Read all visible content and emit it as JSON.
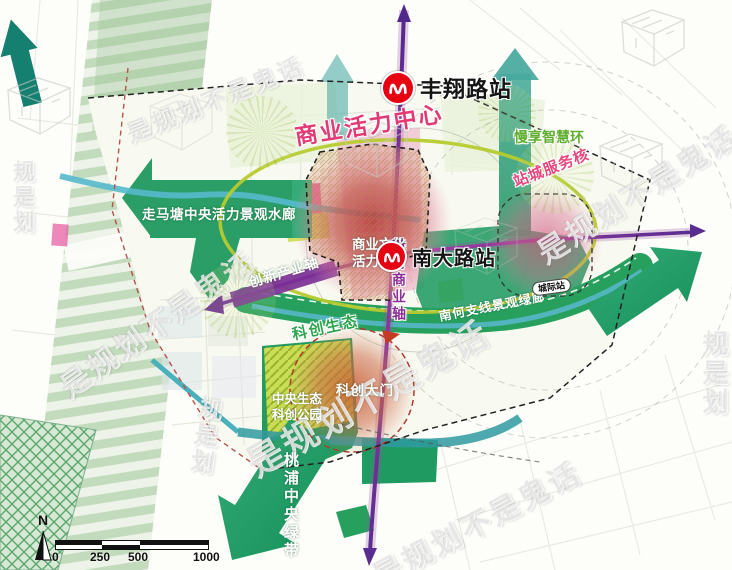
{
  "map": {
    "stations": {
      "fengxiang": "丰翔路站",
      "nanda": "南大路站",
      "intercity": "城际站"
    },
    "labels": {
      "commercial_center": "商业活力中心",
      "smart_ring": "慢享智慧环",
      "station_city_core": "站城服务核",
      "water_corridor": "走马塘中央活力景观水廊",
      "innovation_axis": "创新产业轴",
      "charm_commerce_axis": "魅力商业轴",
      "scitech_eco_axis": "科创生态",
      "nanhe_green_corridor": "南何支线景观绿廊",
      "commerce_park_line1": "商业文化",
      "commerce_park_line2": "活力公园",
      "scitech_gate": "科创大门",
      "central_park_line1": "中央生态",
      "central_park_line2": "科创公园",
      "taopu_green_belt": "桃浦中央绿带"
    },
    "legend": {
      "north": "N",
      "scale": {
        "t0": "0",
        "t1": "250",
        "t2": "500",
        "t3": "1000"
      }
    },
    "watermark": {
      "phrase": "是规划不是鬼话",
      "stamp": "规是划"
    },
    "colors": {
      "metro_red": "#e60012",
      "axis_purple": "#7b2f96",
      "ring_yellowgreen": "#b7cb2f",
      "corridor_green": "#239c62",
      "core_pink": "#e23a74"
    }
  }
}
